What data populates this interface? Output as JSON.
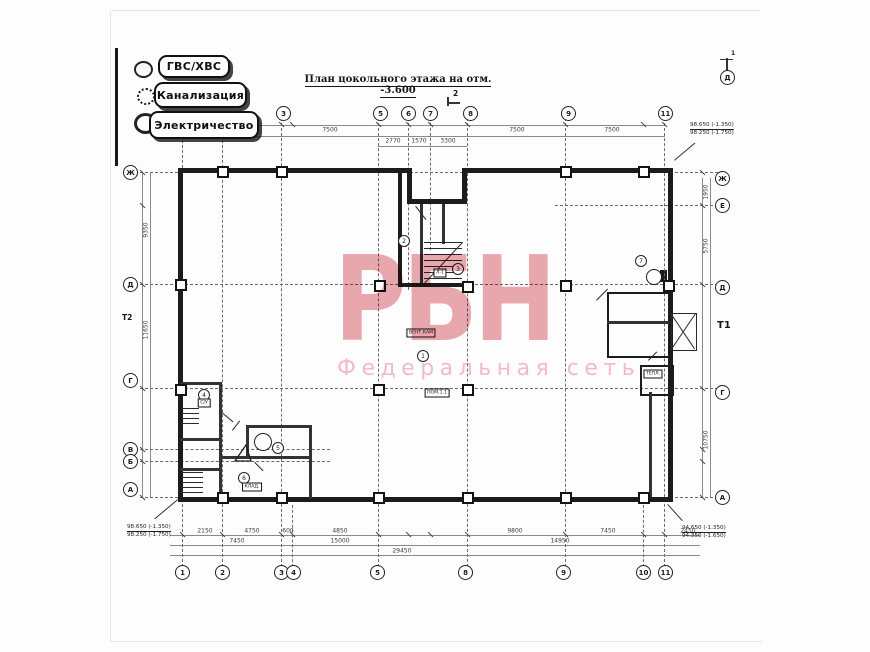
{
  "colors": {
    "paper": "#fdfdfd",
    "ink": "#1b1b1b",
    "watermark_brand": "#dd7a86",
    "watermark_subtitle": "#f2b3bc"
  },
  "legend": {
    "items": [
      {
        "label": "ГВС/ХВС"
      },
      {
        "label": "Канализация"
      },
      {
        "label": "Электричество"
      }
    ]
  },
  "title": {
    "text": "План цокольного этажа на отм. -3.600"
  },
  "watermark": {
    "brand": "РБН",
    "subtitle": "Федеральная сеть"
  },
  "plan": {
    "axis_circles": {
      "top": [
        {
          "label": "3",
          "x": 283
        },
        {
          "label": "5",
          "x": 380
        },
        {
          "label": "6",
          "x": 408
        },
        {
          "label": "7",
          "x": 430
        },
        {
          "label": "8",
          "x": 470
        },
        {
          "label": "9",
          "x": 568
        },
        {
          "label": "11",
          "x": 665
        }
      ],
      "bottom": [
        {
          "label": "1",
          "x": 182
        },
        {
          "label": "2",
          "x": 222
        },
        {
          "label": "3",
          "x": 281
        },
        {
          "label": "4",
          "x": 293
        },
        {
          "label": "5",
          "x": 377
        },
        {
          "label": "8",
          "x": 465
        },
        {
          "label": "9",
          "x": 563
        },
        {
          "label": "10",
          "x": 643
        },
        {
          "label": "11",
          "x": 665
        }
      ],
      "left": [
        {
          "label": "Ж",
          "y": 172
        },
        {
          "label": "Д",
          "y": 284
        },
        {
          "label": "Г",
          "y": 380
        },
        {
          "label": "В",
          "y": 449
        },
        {
          "label": "Б",
          "y": 461
        },
        {
          "label": "А",
          "y": 489
        }
      ],
      "right": [
        {
          "label": "Ж",
          "y": 178
        },
        {
          "label": "Е",
          "y": 205
        },
        {
          "label": "Д",
          "y": 287
        },
        {
          "label": "Г",
          "y": 392
        },
        {
          "label": "А",
          "y": 497
        }
      ]
    },
    "grid": {
      "cols": [
        {
          "x": 182,
          "y1": 120,
          "y2": 572
        },
        {
          "x": 222,
          "y1": 120,
          "y2": 572
        },
        {
          "x": 281,
          "y1": 108,
          "y2": 572
        },
        {
          "x": 292,
          "y1": 505,
          "y2": 572
        },
        {
          "x": 378,
          "y1": 108,
          "y2": 572
        },
        {
          "x": 408,
          "y1": 108,
          "y2": 290
        },
        {
          "x": 430,
          "y1": 108,
          "y2": 250
        },
        {
          "x": 467,
          "y1": 108,
          "y2": 572
        },
        {
          "x": 565,
          "y1": 108,
          "y2": 572
        },
        {
          "x": 643,
          "y1": 505,
          "y2": 572
        },
        {
          "x": 664,
          "y1": 108,
          "y2": 572
        }
      ],
      "rows": [
        {
          "y": 172,
          "x1": 140,
          "x2": 718
        },
        {
          "y": 205,
          "x1": 555,
          "x2": 718
        },
        {
          "y": 284,
          "x1": 140,
          "x2": 718
        },
        {
          "y": 388,
          "x1": 140,
          "x2": 718
        },
        {
          "y": 449,
          "x1": 140,
          "x2": 330
        },
        {
          "y": 461,
          "x1": 140,
          "x2": 330
        },
        {
          "y": 497,
          "x1": 140,
          "x2": 718
        }
      ]
    },
    "columns": [
      [
        222,
        171
      ],
      [
        281,
        171
      ],
      [
        565,
        171
      ],
      [
        643,
        171
      ],
      [
        180,
        284
      ],
      [
        379,
        285
      ],
      [
        467,
        286
      ],
      [
        565,
        285
      ],
      [
        668,
        285
      ],
      [
        180,
        389
      ],
      [
        378,
        389
      ],
      [
        467,
        389
      ],
      [
        222,
        497
      ],
      [
        281,
        497
      ],
      [
        378,
        497
      ],
      [
        467,
        497
      ],
      [
        565,
        497
      ],
      [
        643,
        497
      ]
    ],
    "dim_labels": {
      "top": [
        {
          "x": 330,
          "y": 130,
          "t": "7500"
        },
        {
          "x": 517,
          "y": 130,
          "t": "7500"
        },
        {
          "x": 612,
          "y": 130,
          "t": "7500"
        },
        {
          "x": 393,
          "y": 141,
          "t": "2770"
        },
        {
          "x": 419,
          "y": 141,
          "t": "1570"
        },
        {
          "x": 448,
          "y": 141,
          "t": "3300"
        }
      ],
      "bottom": [
        {
          "x": 205,
          "y": 531,
          "t": "2150"
        },
        {
          "x": 252,
          "y": 531,
          "t": "4750"
        },
        {
          "x": 288,
          "y": 531,
          "t": "600"
        },
        {
          "x": 340,
          "y": 531,
          "t": "4850"
        },
        {
          "x": 515,
          "y": 531,
          "t": "9800"
        },
        {
          "x": 608,
          "y": 531,
          "t": "7450"
        },
        {
          "x": 688,
          "y": 531,
          "t": "2450"
        },
        {
          "x": 237,
          "y": 541,
          "t": "7450"
        },
        {
          "x": 340,
          "y": 541,
          "t": "15000"
        },
        {
          "x": 560,
          "y": 541,
          "t": "14950"
        },
        {
          "x": 402,
          "y": 551,
          "t": "29450"
        }
      ],
      "left": [
        {
          "x": 146,
          "y": 230,
          "t": "9350"
        },
        {
          "x": 146,
          "y": 330,
          "t": "11650"
        }
      ],
      "right": [
        {
          "x": 706,
          "y": 192,
          "t": "1950"
        },
        {
          "x": 706,
          "y": 246,
          "t": "5750"
        },
        {
          "x": 706,
          "y": 440,
          "t": "10750"
        }
      ]
    },
    "markers": [
      {
        "t": "2",
        "x": 403,
        "y": 240
      },
      {
        "t": "3",
        "x": 457,
        "y": 268
      },
      {
        "t": "1",
        "x": 422,
        "y": 355
      },
      {
        "t": "4",
        "x": 203,
        "y": 394
      },
      {
        "t": "5",
        "x": 277,
        "y": 447
      },
      {
        "t": "6",
        "x": 243,
        "y": 477
      },
      {
        "t": "7",
        "x": 640,
        "y": 260
      }
    ],
    "tags": [
      {
        "t": "Л-1",
        "x": 440,
        "y": 273
      },
      {
        "t": "ВЕНТ.КАМ",
        "x": 421,
        "y": 333
      },
      {
        "t": "ПОМ.1.1",
        "x": 437,
        "y": 393
      },
      {
        "t": "С/У",
        "x": 204,
        "y": 403
      },
      {
        "t": "КЛАД.",
        "x": 252,
        "y": 487
      },
      {
        "t": "ТЕПЛ.",
        "x": 653,
        "y": 374
      }
    ],
    "elevations": {
      "top_right": [
        "98.650 (-1.350)",
        "98.250 (-1.750)"
      ],
      "bottom_left": [
        "98.650 (-1.350)",
        "98.250 (-1.750)"
      ],
      "bottom_right": [
        "94.650 (-1.350)",
        "94.350 (-1.650)"
      ]
    },
    "section_marks": {
      "top": "2",
      "top_right_num": "1",
      "top_right_axis": "Д",
      "left": "Т2",
      "right": "Т1"
    }
  }
}
